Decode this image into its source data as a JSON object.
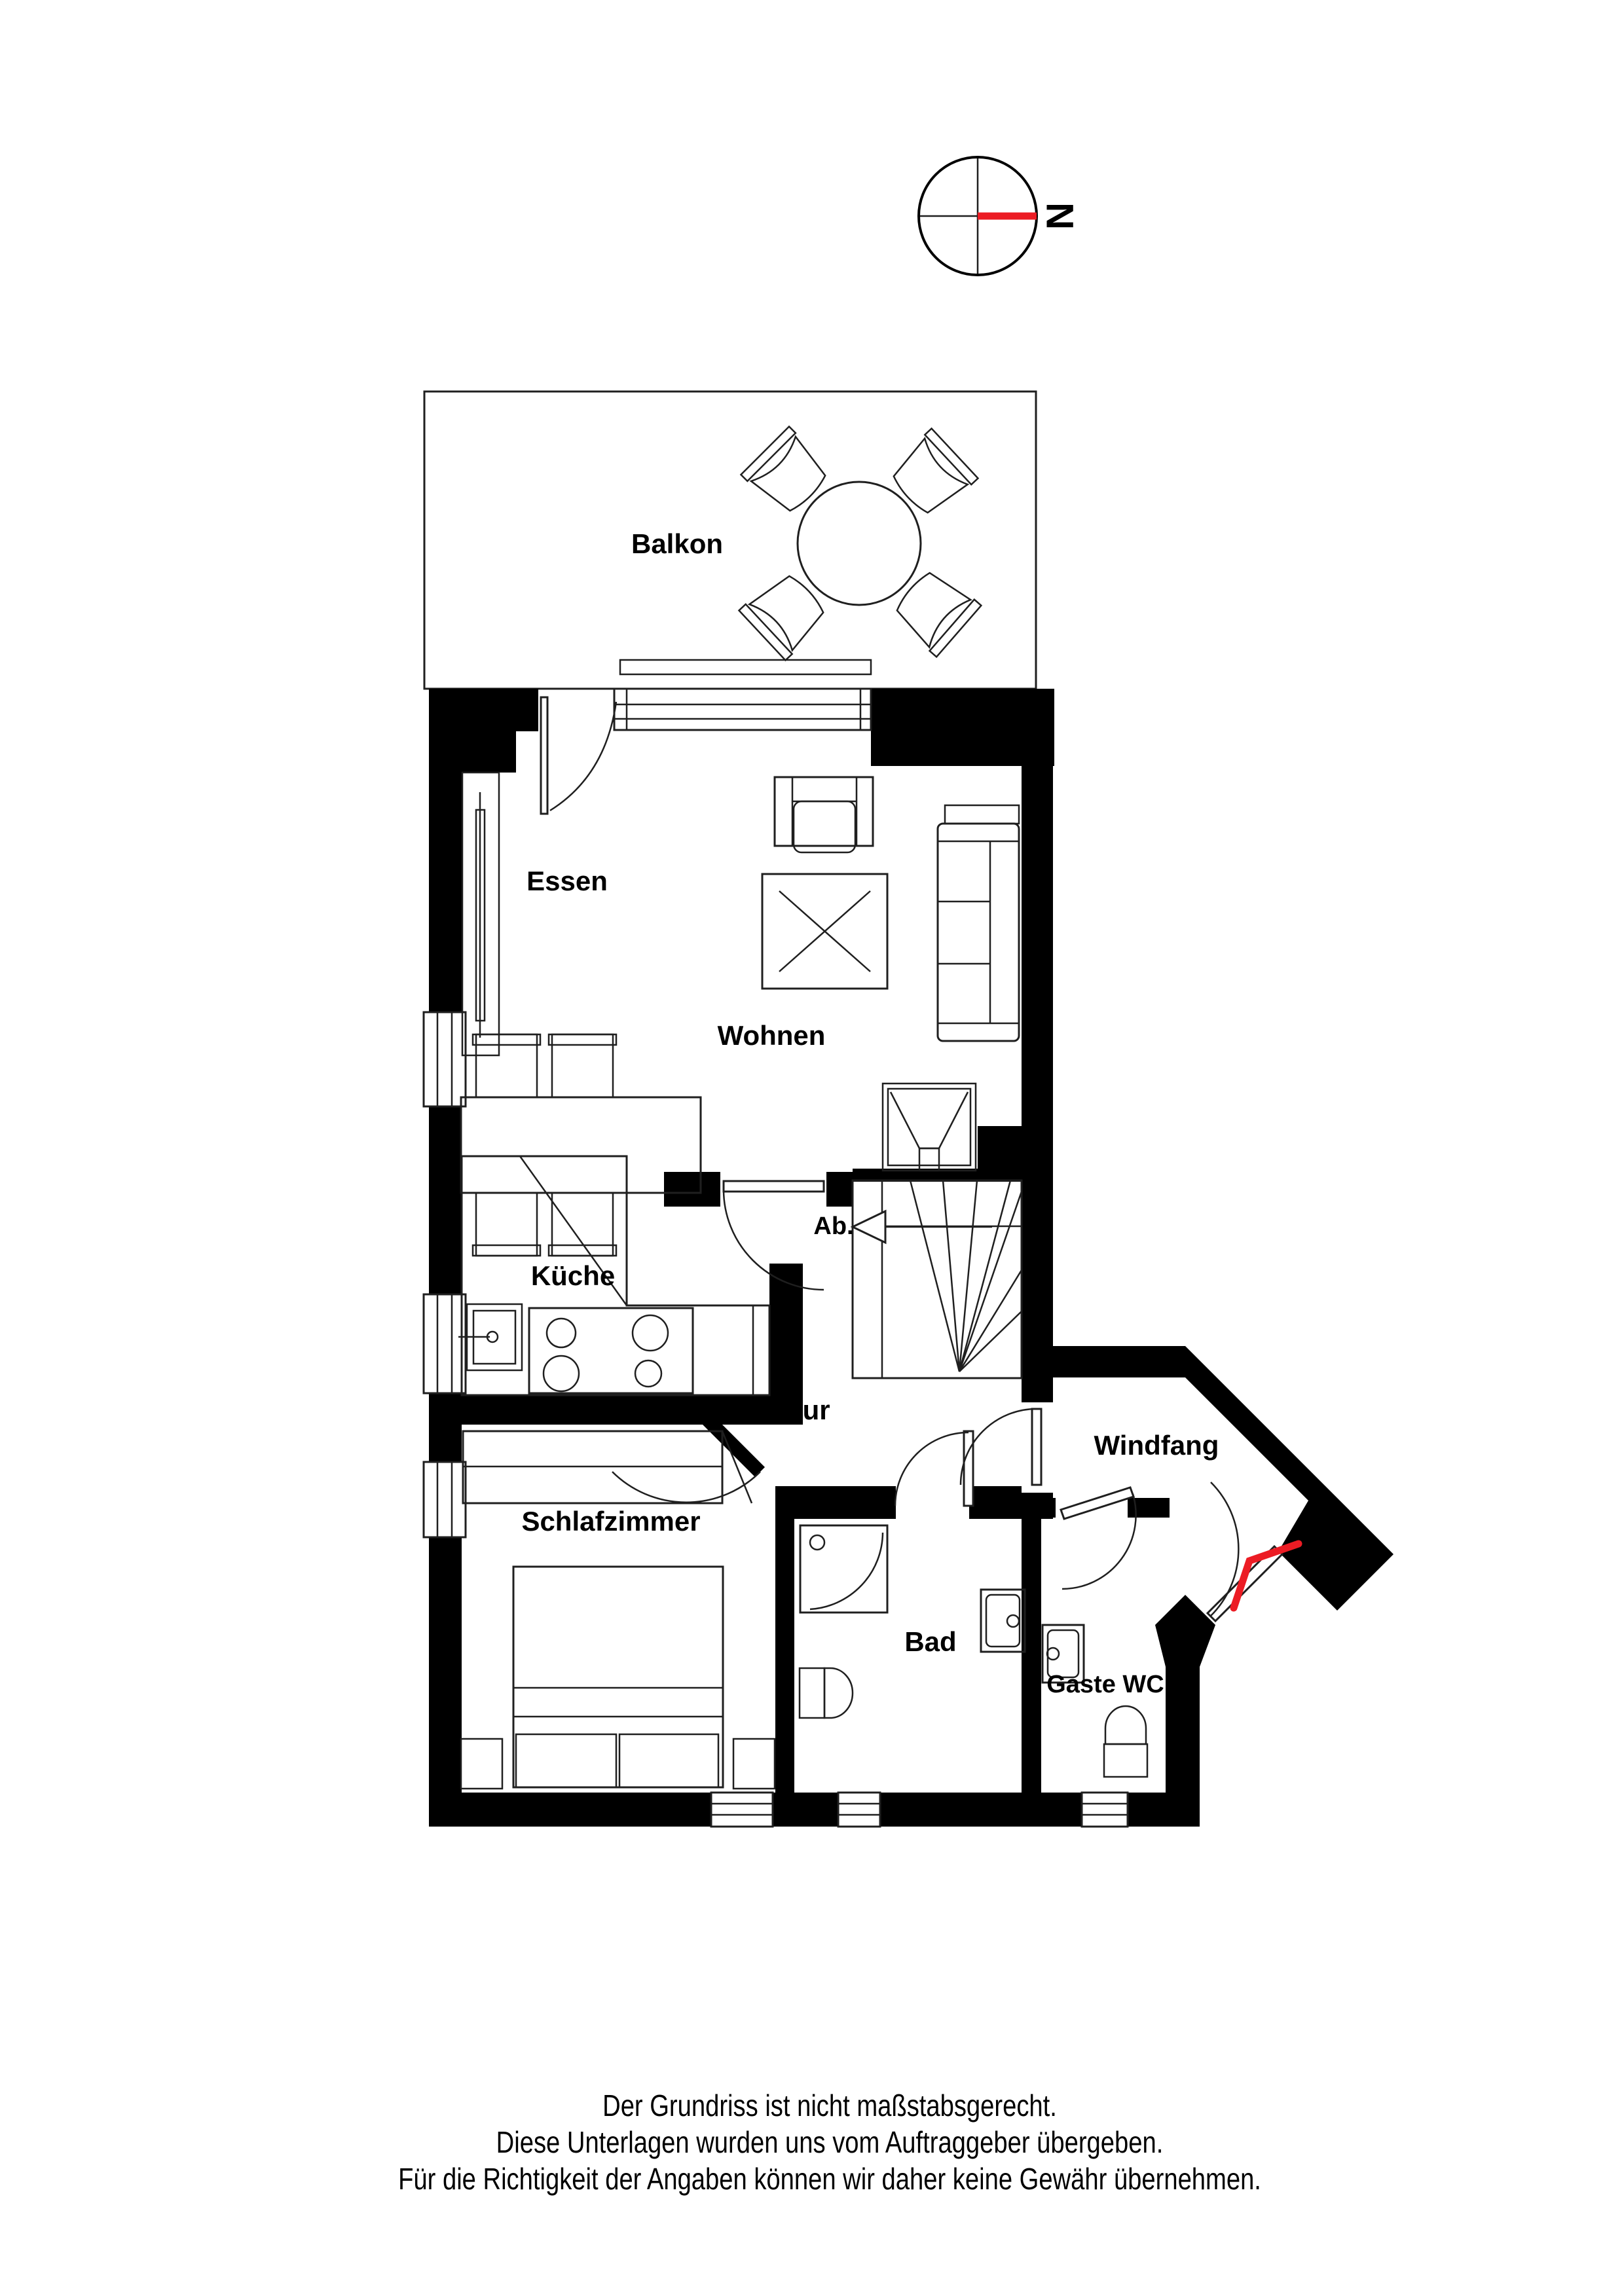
{
  "compass": {
    "label": "N"
  },
  "rooms": {
    "balkon": "Balkon",
    "essen": "Essen",
    "wohnen": "Wohnen",
    "kueche": "Küche",
    "ab": "Ab.",
    "flur": "Flur",
    "windfang": "Windfang",
    "schlafzimmer": "Schlafzimmer",
    "bad": "Bad",
    "gaestewc": "Gaste WC"
  },
  "footer": {
    "line1": "Der Grundriss ist nicht maßstabsgerecht.",
    "line2": "Diese Unterlagen wurden uns vom Auftraggeber übergeben.",
    "line3": "Für die Richtigkeit der Angaben können wir daher keine Gewähr übernehmen."
  },
  "colors": {
    "wall": "#000000",
    "accent_red": "#ec1c24"
  }
}
